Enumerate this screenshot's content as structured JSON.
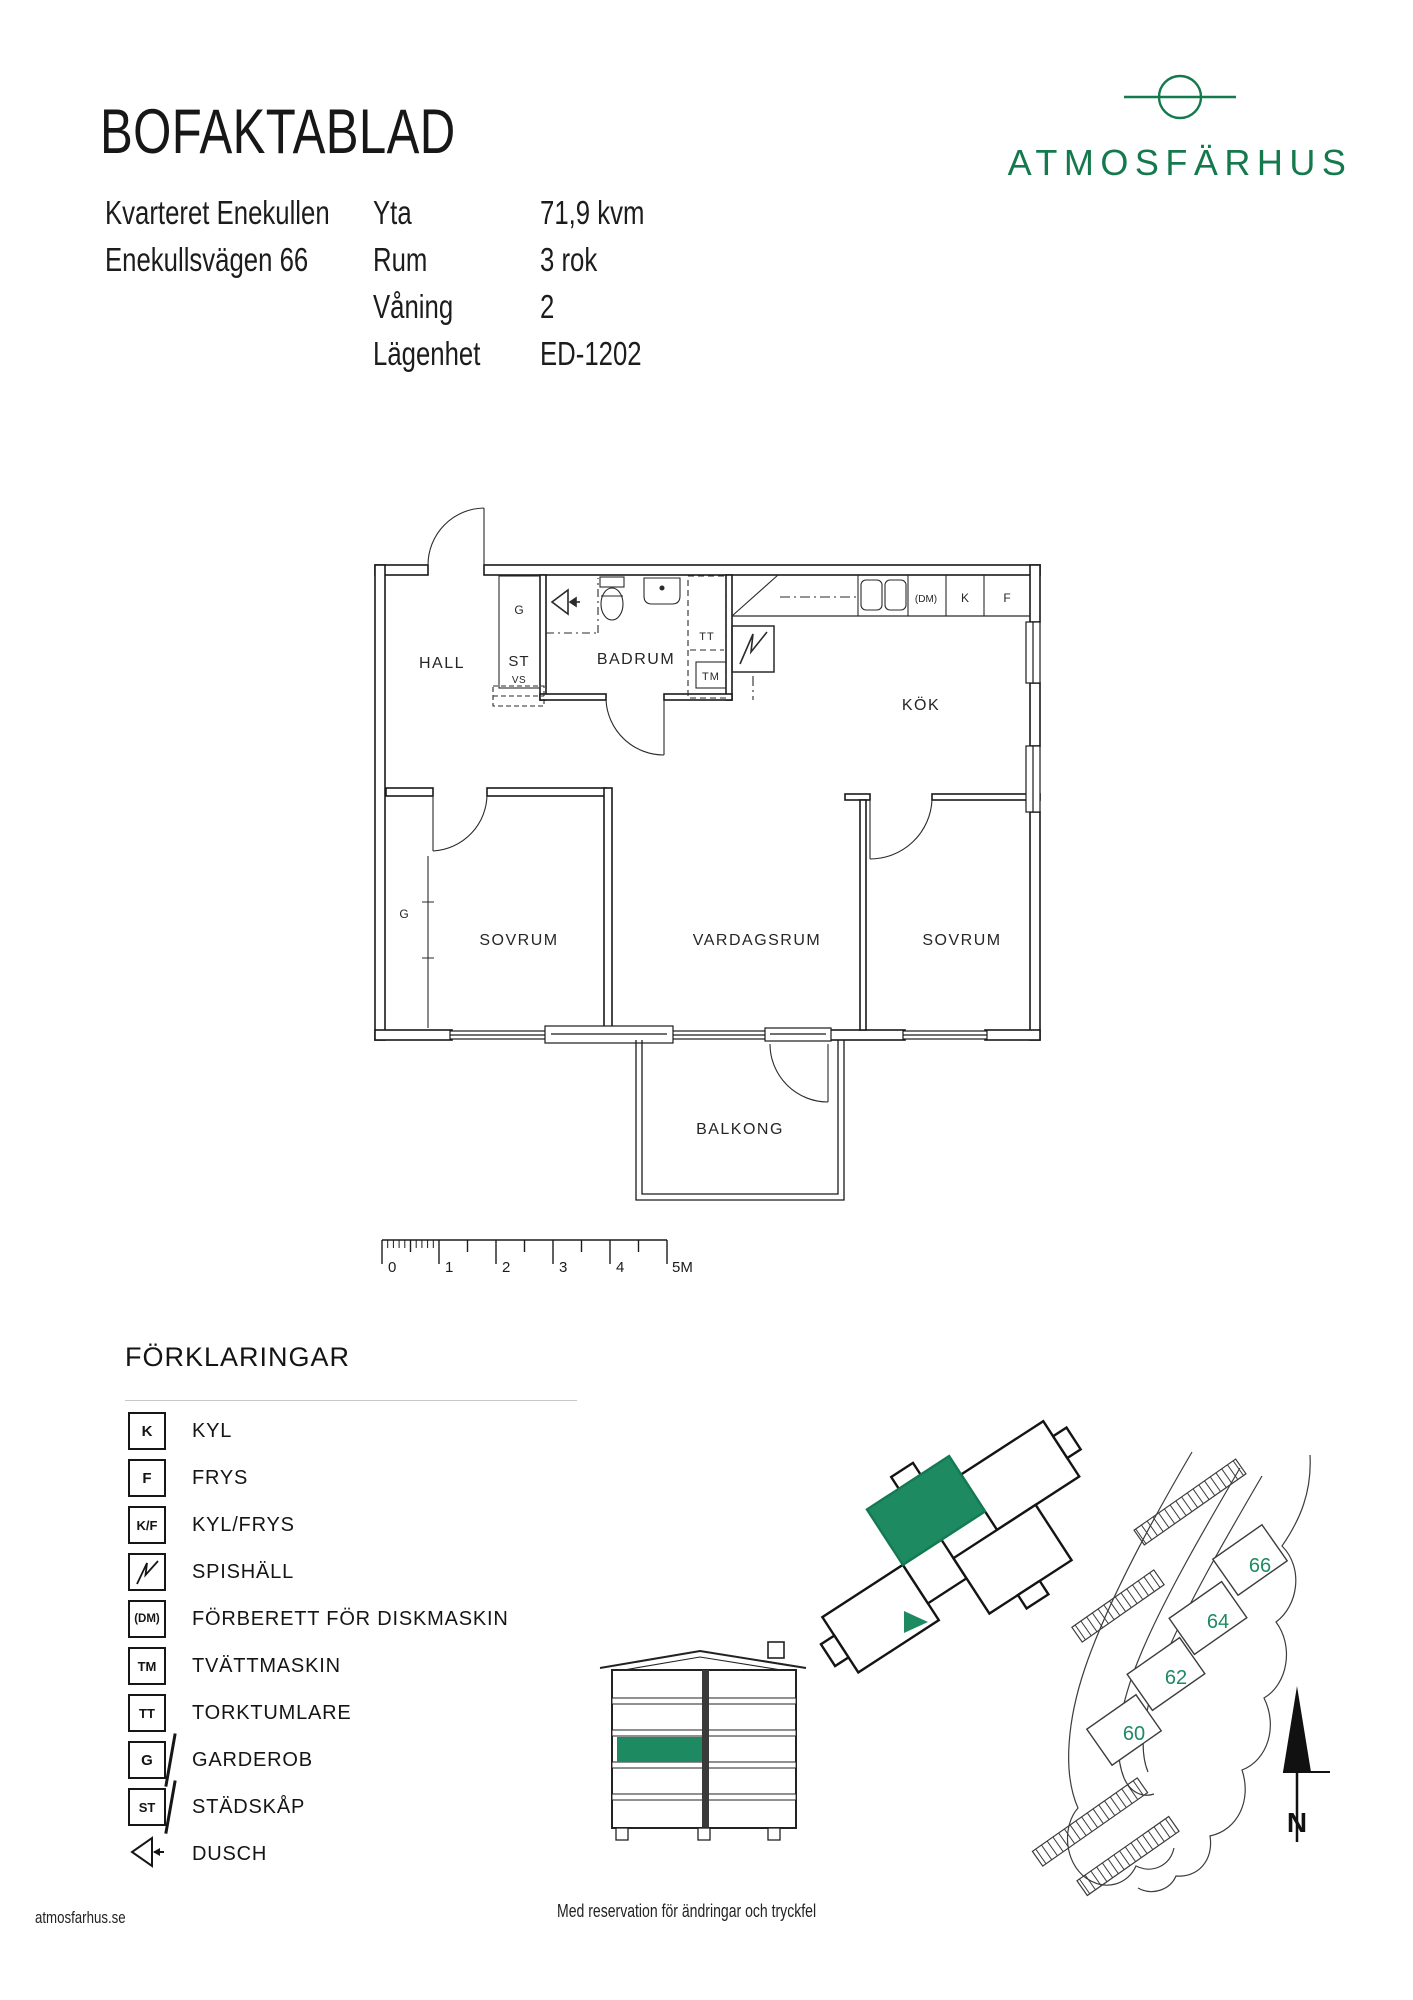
{
  "header": {
    "title": "BOFAKTABLAD",
    "address_line1": "Kvarteret Enekullen",
    "address_line2": "Enekullsvägen 66",
    "facts": [
      {
        "label": "Yta",
        "value": "71,9 kvm"
      },
      {
        "label": "Rum",
        "value": "3 rok"
      },
      {
        "label": "Våning",
        "value": "2"
      },
      {
        "label": "Lägenhet",
        "value": "ED-1202"
      }
    ]
  },
  "logo": {
    "text": "ATMOSFÄRHUS"
  },
  "floorplan": {
    "labels": {
      "hall": "HALL",
      "badrum": "BADRUM",
      "kok": "KÖK",
      "sovrum_left": "SOVRUM",
      "vardagsrum": "VARDAGSRUM",
      "sovrum_right": "SOVRUM",
      "balkong": "BALKONG",
      "closet_g": "G",
      "closet_st": "ST",
      "closet_vs": "VS",
      "tt": "TT",
      "tm": "TM",
      "dm": "(DM)",
      "k": "K",
      "f": "F",
      "wardrobe_g": "G"
    },
    "scale": {
      "ticks": [
        "0",
        "1",
        "2",
        "3",
        "4"
      ],
      "end_label": "5M"
    }
  },
  "legend": {
    "title": "FÖRKLARINGAR",
    "items": [
      {
        "symbol": "K",
        "label": "KYL"
      },
      {
        "symbol": "F",
        "label": "FRYS"
      },
      {
        "symbol": "K/F",
        "label": "KYL/FRYS"
      },
      {
        "symbol": "",
        "label": "SPISHÄLL"
      },
      {
        "symbol": "(DM)",
        "label": "FÖRBERETT FÖR DISKMASKIN"
      },
      {
        "symbol": "TM",
        "label": "TVÄTTMASKIN"
      },
      {
        "symbol": "TT",
        "label": "TORKTUMLARE"
      },
      {
        "symbol": "G",
        "label": "GARDEROB"
      },
      {
        "symbol": "ST",
        "label": "STÄDSKÅP"
      },
      {
        "symbol": "",
        "label": "DUSCH"
      }
    ]
  },
  "site": {
    "numbers": [
      "66",
      "64",
      "62",
      "60"
    ],
    "north": "N"
  },
  "footer": {
    "website": "atmosfarhus.se",
    "disclaimer": "Med reservation för ändringar och tryckfel"
  },
  "colors": {
    "logo_green": "#15794E",
    "accent_green": "#1E8A62",
    "ink": "#1a1a1a"
  }
}
